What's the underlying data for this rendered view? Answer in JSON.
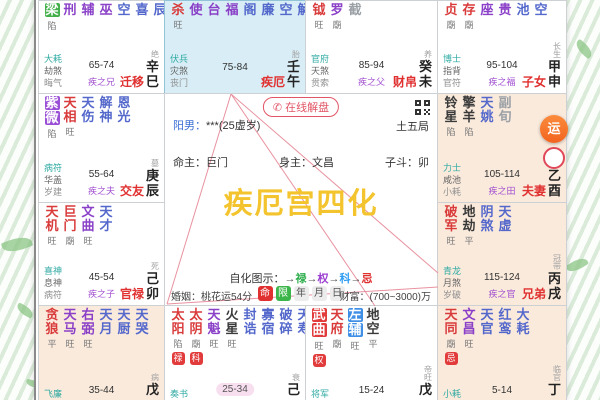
{
  "center": {
    "consult": "在线解盘",
    "consult_icon": "✆",
    "bureau": "土五局",
    "gender_label": "阳男：",
    "gender_value": "***(25虚岁)",
    "ming_zhu": "命主：巨门",
    "shen_zhu": "身主：文昌",
    "zi_dou": "子斗：卯",
    "watermark": "疾厄宫四化",
    "legend_label": "自化图示：",
    "arrow": "→",
    "legend": [
      {
        "label": "禄",
        "color": "#2fae4d"
      },
      {
        "label": "权",
        "color": "#9c3fd0"
      },
      {
        "label": "科",
        "color": "#2f9df2"
      },
      {
        "label": "忌",
        "color": "#e03030"
      }
    ],
    "mode_buttons": [
      {
        "label": "命",
        "bg": "#e03030",
        "fg": "#ffffff"
      },
      {
        "label": "限",
        "bg": "#3cb54a",
        "fg": "#ffffff"
      },
      {
        "label": "年",
        "bg": "#ececec",
        "fg": "#555555"
      },
      {
        "label": "月",
        "bg": "#ececec",
        "fg": "#555555"
      },
      {
        "label": "日",
        "bg": "#ececec",
        "fg": "#555555"
      }
    ],
    "marriage": "婚姻：桃花运54分",
    "wealth": "财富：(700~3000)万",
    "float_button": "运"
  },
  "palaces": {
    "qianyi": {
      "name": "迁移",
      "branch": "巳",
      "stem": "辛",
      "stage": "绝",
      "range": "65-74",
      "rel": "疾之兄",
      "gods": [
        "大耗",
        "劫煞",
        "晦气"
      ],
      "stars": [
        {
          "t": "梁",
          "c": "hlgreen",
          "s": "陷"
        },
        {
          "t": "刑",
          "c": "purple"
        },
        {
          "t": "辅",
          "c": "purple"
        },
        {
          "t": "巫",
          "c": "purple"
        },
        {
          "t": "空",
          "c": "blue"
        },
        {
          "t": "喜",
          "c": "blue"
        },
        {
          "t": "辰",
          "c": "blue"
        }
      ]
    },
    "jie": {
      "name": "疾厄",
      "branch": "午",
      "stem": "壬",
      "stage": "胎",
      "range": "75-84",
      "rel": "",
      "gods": [
        "伏兵",
        "灾煞",
        "丧门"
      ],
      "stars": [
        {
          "t": "杀",
          "c": "red",
          "s": "旺"
        },
        {
          "t": "使",
          "c": "purple"
        },
        {
          "t": "台",
          "c": "purple"
        },
        {
          "t": "福",
          "c": "purple"
        },
        {
          "t": "阁",
          "c": "blue"
        },
        {
          "t": "廉",
          "c": "blue"
        },
        {
          "t": "空",
          "c": "blue"
        },
        {
          "t": "解",
          "c": "blue"
        }
      ]
    },
    "caibo": {
      "name": "财帛",
      "branch": "未",
      "stem": "癸",
      "stage": "养",
      "range": "85-94",
      "rel": "疾之父",
      "gods": [
        "官府",
        "天煞",
        "贯索"
      ],
      "stars": [
        {
          "t": "钺",
          "c": "red",
          "s": "旺"
        },
        {
          "t": "罗",
          "c": "purple",
          "s": "廟"
        },
        {
          "t": "截",
          "c": "gray"
        }
      ]
    },
    "zinv": {
      "name": "子女",
      "branch": "申",
      "stem": "甲",
      "stage": "长生",
      "range": "95-104",
      "rel": "疾之福",
      "gods": [
        "博士",
        "指背",
        "官符"
      ],
      "stars": [
        {
          "t": "贞",
          "c": "red",
          "s": "廟"
        },
        {
          "t": "存",
          "c": "red",
          "s": "廟"
        },
        {
          "t": "座",
          "c": "purple"
        },
        {
          "t": "贵",
          "c": "purple"
        },
        {
          "t": "池",
          "c": "blue"
        },
        {
          "t": "空",
          "c": "blue"
        }
      ]
    },
    "jiaoyou": {
      "name": "交友",
      "branch": "辰",
      "stem": "庚",
      "stage": "墓",
      "range": "55-64",
      "rel": "疾之夫",
      "gods": [
        "病符",
        "华盖",
        "岁建"
      ],
      "stars": [
        {
          "t": "紫微",
          "c": "hlpurple",
          "s": "陷"
        },
        {
          "t": "天相",
          "c": "red",
          "s": "旺"
        },
        {
          "t": "天伤",
          "c": "blue"
        },
        {
          "t": "解神",
          "c": "blue"
        },
        {
          "t": "恩光",
          "c": "blue"
        }
      ]
    },
    "fuqi": {
      "name": "夫妻",
      "branch": "酉",
      "stem": "乙",
      "stage": "沐浴",
      "range": "105-114",
      "rel": "疾之田",
      "gods": [
        "力士",
        "咸池",
        "小耗"
      ],
      "stars": [
        {
          "t": "铃星",
          "c": "black",
          "s": "陷"
        },
        {
          "t": "擎羊",
          "c": "black",
          "s": "陷"
        },
        {
          "t": "天姚",
          "c": "blue"
        },
        {
          "t": "副旬",
          "c": "gray"
        }
      ]
    },
    "guanlu": {
      "name": "官禄",
      "branch": "卯",
      "stem": "己",
      "stage": "死",
      "range": "45-54",
      "rel": "疾之子",
      "gods": [
        "喜神",
        "息神",
        "病符"
      ],
      "stars": [
        {
          "t": "天机",
          "c": "red",
          "s": "旺"
        },
        {
          "t": "巨门",
          "c": "red",
          "s": "廟"
        },
        {
          "t": "文曲",
          "c": "purple",
          "s": "旺"
        },
        {
          "t": "天才",
          "c": "blue"
        }
      ]
    },
    "xiongdi": {
      "name": "兄弟",
      "branch": "戌",
      "stem": "丙",
      "stage": "冠带",
      "range": "115-124",
      "rel": "疾之官",
      "gods": [
        "青龙",
        "月煞",
        "岁破"
      ],
      "stars": [
        {
          "t": "破军",
          "c": "red",
          "s": "旺"
        },
        {
          "t": "地劫",
          "c": "black",
          "s": "平"
        },
        {
          "t": "阴煞",
          "c": "blue"
        },
        {
          "t": "天虚",
          "c": "blue"
        }
      ]
    },
    "tianzhai": {
      "name": "",
      "branch": "",
      "stem": "戊",
      "stage": "病",
      "range": "35-44",
      "rel": "",
      "gods": [
        "飞廉",
        "岁驿"
      ],
      "stars": [
        {
          "t": "贪狼",
          "c": "red",
          "s": "平"
        },
        {
          "t": "天马",
          "c": "purple",
          "s": "旺"
        },
        {
          "t": "右弼",
          "c": "purple",
          "s": "旺"
        },
        {
          "t": "天月",
          "c": "blue"
        },
        {
          "t": "天厨",
          "c": "blue"
        },
        {
          "t": "天哭",
          "c": "blue"
        }
      ]
    },
    "fude": {
      "name": "",
      "branch": "",
      "stem": "己",
      "stage": "衰",
      "range": "25-34",
      "rangeHl": true,
      "rel": "",
      "gods": [
        "奏书",
        "攀鞍"
      ],
      "stars": [
        {
          "t": "太阳",
          "c": "red",
          "s": "陷",
          "b": "禄"
        },
        {
          "t": "太阴",
          "c": "red",
          "s": "廟",
          "b": "科"
        },
        {
          "t": "天魁",
          "c": "purple",
          "s": "旺"
        },
        {
          "t": "火星",
          "c": "black",
          "s": "旺"
        },
        {
          "t": "封诰",
          "c": "blue"
        },
        {
          "t": "寡宿",
          "c": "blue"
        },
        {
          "t": "破碎",
          "c": "blue"
        },
        {
          "t": "天寿",
          "c": "blue"
        }
      ]
    },
    "fumu": {
      "name": "",
      "branch": "",
      "stem": "戊",
      "stage": "帝旺",
      "range": "15-24",
      "rel": "",
      "gods": [
        "将军",
        "将星"
      ],
      "stars": [
        {
          "t": "武曲",
          "c": "hlred",
          "s": "旺",
          "b": "权"
        },
        {
          "t": "天府",
          "c": "red",
          "s": "廟"
        },
        {
          "t": "左辅",
          "c": "hlblue",
          "s": "旺"
        },
        {
          "t": "地空",
          "c": "black",
          "s": "平"
        }
      ]
    },
    "minggong": {
      "name": "",
      "branch": "",
      "stem": "丁",
      "stage": "临官",
      "range": "5-14",
      "rel": "",
      "gods": [
        "小耗",
        "亡神"
      ],
      "stars": [
        {
          "t": "天同",
          "c": "red",
          "s": "廟",
          "b": "忌"
        },
        {
          "t": "文昌",
          "c": "purple",
          "s": "旺"
        },
        {
          "t": "天官",
          "c": "blue"
        },
        {
          "t": "红鸾",
          "c": "blue"
        },
        {
          "t": "大耗",
          "c": "blue"
        }
      ]
    }
  }
}
